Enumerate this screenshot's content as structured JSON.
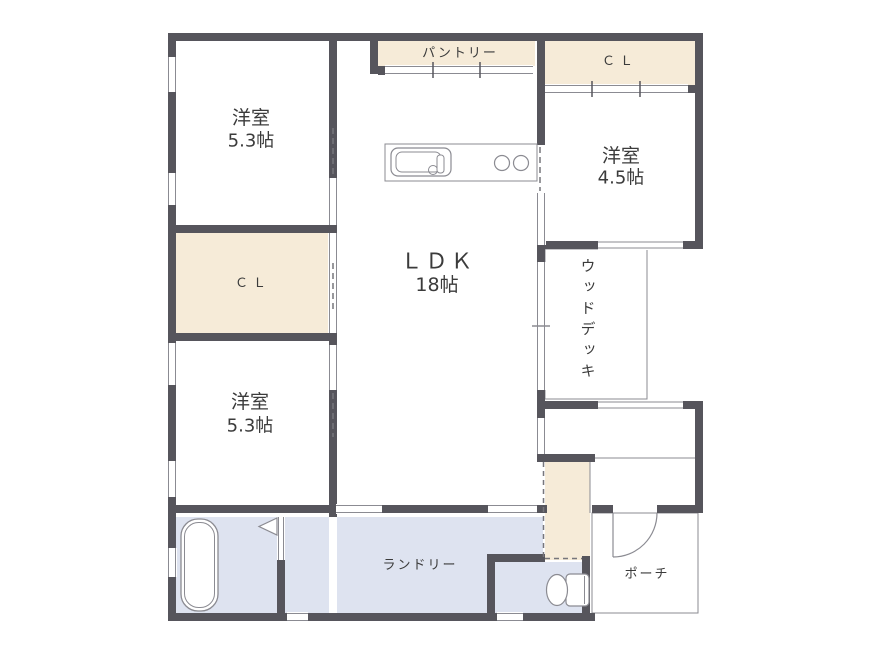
{
  "floorplan": {
    "rooms": {
      "bedroom_top_left": {
        "name": "洋室",
        "size": "5.3帖"
      },
      "bedroom_bottom_left": {
        "name": "洋室",
        "size": "5.3帖"
      },
      "bedroom_right": {
        "name": "洋室",
        "size": "4.5帖"
      },
      "ldk": {
        "name": "ＬＤＫ",
        "size": "18帖"
      },
      "pantry": {
        "label": "パントリー"
      },
      "closet_top_right": {
        "label": "ＣＬ"
      },
      "closet_left": {
        "label": "ＣＬ"
      },
      "wood_deck": {
        "label": "ウッドデッキ"
      },
      "laundry": {
        "label": "ランドリー"
      },
      "porch": {
        "label": "ポーチ"
      }
    },
    "colors": {
      "wall": "#56555c",
      "closet_fill": "#f6ebd8",
      "wet_area_fill": "#dee3f0",
      "thin_line": "#8b8b92",
      "text": "#3b3b3b",
      "background": "#ffffff"
    },
    "fixtures": [
      "kitchen-sink",
      "stove-burners",
      "bathtub",
      "toilet",
      "entry-door",
      "bath-folding-door"
    ]
  }
}
